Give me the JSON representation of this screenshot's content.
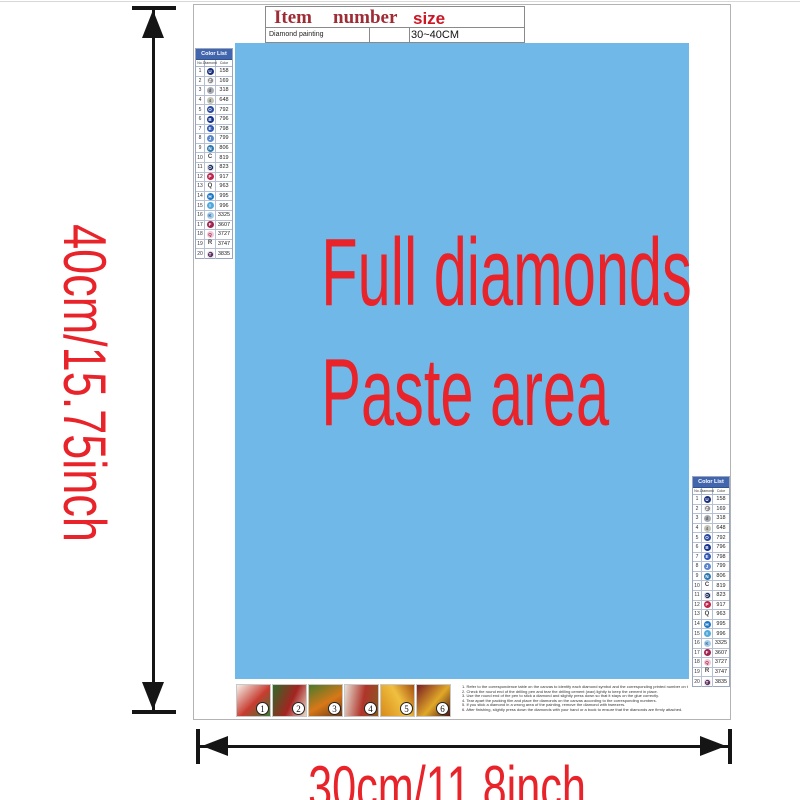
{
  "colors": {
    "paste_blue": "#6fb8e8",
    "accent_red": "#e8232a",
    "table_header_dark_red": "#9e2c35",
    "table_size_red": "#cc1622",
    "list_header_blue": "#4166ae"
  },
  "info_table": {
    "col_item": "Item",
    "col_number": "number",
    "col_size": "size",
    "item_value": "Diamond painting",
    "number_value": "",
    "size_value": "30~40CM"
  },
  "paste_area": {
    "line1": "Full diamonds",
    "line2": "Paste area"
  },
  "dims": {
    "height_label": "40cm/15.75inch",
    "width_label": "30cm/11.8inch"
  },
  "color_list": {
    "title": "Color List",
    "columns": [
      "No.",
      "Diamond",
      "Color"
    ],
    "rows": [
      {
        "no": "1",
        "symbol": "U",
        "code": "158",
        "circle": true,
        "ring": false,
        "bg": "#1c2f7a",
        "fg": "#ffffff"
      },
      {
        "no": "2",
        "symbol": "Z",
        "code": "169",
        "circle": true,
        "ring": true,
        "bg": "#8c8c8c",
        "fg": "#ffffff"
      },
      {
        "no": "3",
        "symbol": "d",
        "code": "318",
        "circle": true,
        "ring": false,
        "bg": "#a8acb2",
        "fg": "#555555"
      },
      {
        "no": "4",
        "symbol": "4",
        "code": "648",
        "circle": true,
        "ring": false,
        "bg": "#c2c4b8",
        "fg": "#666666"
      },
      {
        "no": "5",
        "symbol": "O",
        "code": "792",
        "circle": true,
        "ring": false,
        "bg": "#2c4a9e",
        "fg": "#ffffff"
      },
      {
        "no": "6",
        "symbol": "B",
        "code": "796",
        "circle": true,
        "ring": false,
        "bg": "#16348c",
        "fg": "#ffffff"
      },
      {
        "no": "7",
        "symbol": "E",
        "code": "798",
        "circle": true,
        "ring": false,
        "bg": "#2e56b4",
        "fg": "#ffffff"
      },
      {
        "no": "8",
        "symbol": "J",
        "code": "799",
        "circle": true,
        "ring": false,
        "bg": "#5c86cc",
        "fg": "#ffffff"
      },
      {
        "no": "9",
        "symbol": "N",
        "code": "806",
        "circle": true,
        "ring": false,
        "bg": "#2e7ab0",
        "fg": "#ffffff"
      },
      {
        "no": "10",
        "symbol": "C",
        "code": "819",
        "circle": false,
        "ring": false,
        "bg": "",
        "fg": "#444444"
      },
      {
        "no": "11",
        "symbol": "O",
        "code": "823",
        "circle": true,
        "ring": true,
        "bg": "#1a2a5e",
        "fg": "#ffffff"
      },
      {
        "no": "12",
        "symbol": "P",
        "code": "917",
        "circle": true,
        "ring": false,
        "bg": "#c0244a",
        "fg": "#ffffff"
      },
      {
        "no": "13",
        "symbol": "Q",
        "code": "963",
        "circle": false,
        "ring": false,
        "bg": "",
        "fg": "#444444"
      },
      {
        "no": "14",
        "symbol": "H",
        "code": "995",
        "circle": true,
        "ring": false,
        "bg": "#1e78c8",
        "fg": "#ffffff"
      },
      {
        "no": "15",
        "symbol": "I",
        "code": "996",
        "circle": true,
        "ring": false,
        "bg": "#52aadc",
        "fg": "#ffffff"
      },
      {
        "no": "16",
        "symbol": "K",
        "code": "3325",
        "circle": true,
        "ring": false,
        "bg": "#a8cce8",
        "fg": "#3366a0"
      },
      {
        "no": "17",
        "symbol": "F",
        "code": "3607",
        "circle": true,
        "ring": false,
        "bg": "#a12450",
        "fg": "#ffffff"
      },
      {
        "no": "18",
        "symbol": "Q",
        "code": "3727",
        "circle": true,
        "ring": false,
        "bg": "#f0c8d8",
        "fg": "#a02040"
      },
      {
        "no": "19",
        "symbol": "R",
        "code": "3747",
        "circle": false,
        "ring": false,
        "bg": "",
        "fg": "#444444"
      },
      {
        "no": "20",
        "symbol": "T",
        "code": "3835",
        "circle": true,
        "ring": true,
        "bg": "#5c3060",
        "fg": "#ffffff"
      }
    ]
  },
  "steps": [
    {
      "label": "1",
      "colors": [
        "#f5f0ea",
        "#c83c30",
        "#3a7a34"
      ],
      "angle": 135
    },
    {
      "label": "2",
      "colors": [
        "#2e6b28",
        "#a42422",
        "#e8d8c8"
      ],
      "angle": 115
    },
    {
      "label": "3",
      "colors": [
        "#4a7a2c",
        "#d87818",
        "#6b3a1a"
      ],
      "angle": 150
    },
    {
      "label": "4",
      "colors": [
        "#e8e0d4",
        "#b0342a",
        "#8a5a22"
      ],
      "angle": 100
    },
    {
      "label": "5",
      "colors": [
        "#d88a1a",
        "#f0c040",
        "#a85010"
      ],
      "angle": 60
    },
    {
      "label": "6",
      "colors": [
        "#7a1e22",
        "#e0a828",
        "#4a1416"
      ],
      "angle": 130
    }
  ],
  "instructions": [
    "Refer to the correspondence table on the canvas to identify each diamond symbol and the corresponding printed number on the canvas.",
    "Check the round end of the drilling pen and tear the drilling cement (wax) lightly to keep the cement in place.",
    "Use the round end of the pen to stick a diamond and slightly press down so that it stays on the glue correctly.",
    "Tear apart the packing film and place the diamonds on the canvas according to the corresponding numbers.",
    "If you stick a diamond in a wrong area of the painting, remove the diamond with tweezers.",
    "After finishing, slightly press down the diamonds with your hand or a book to ensure that the diamonds are firmly attached."
  ]
}
